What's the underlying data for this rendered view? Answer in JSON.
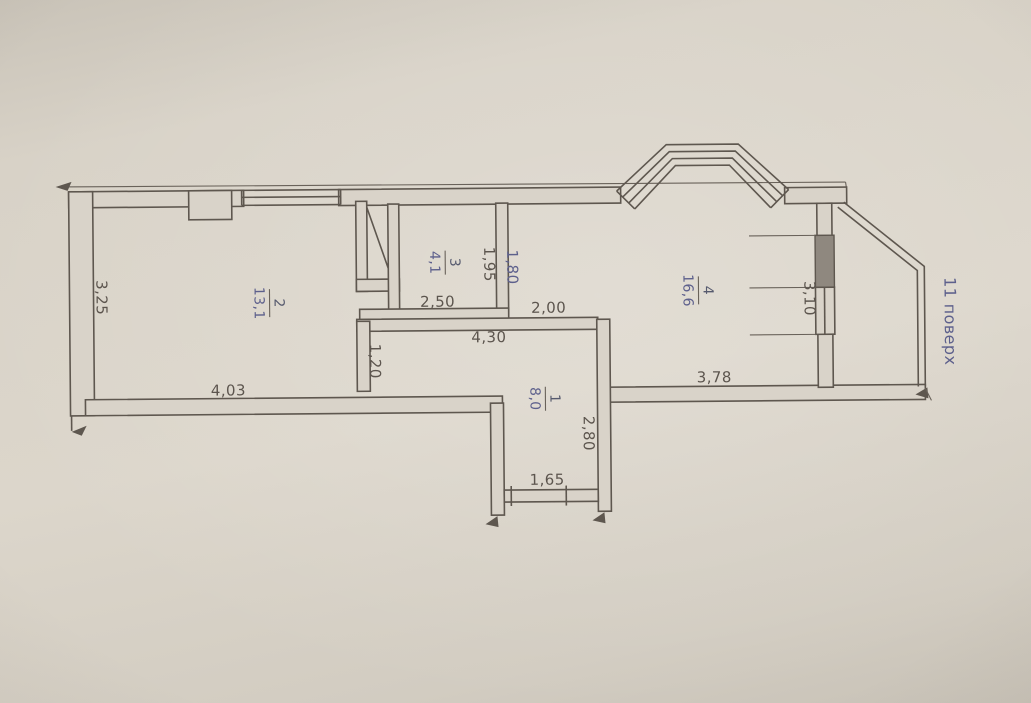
{
  "document": {
    "kind": "apartment floor plan photo",
    "floor_note": "11 поверх"
  },
  "rooms": {
    "r1": {
      "number": "1",
      "area": "8,0"
    },
    "r2": {
      "number": "2",
      "area": "13,1"
    },
    "r3": {
      "number": "3",
      "area": "4,1"
    },
    "r4": {
      "number": "4",
      "area": "16,6"
    }
  },
  "dimensions": {
    "left_wall_height": "3,25",
    "room2_width": "4,03",
    "room2_partition": "1,20",
    "room3_width": "2,50",
    "hall_total_width": "4,30",
    "room3_depth": "1,95",
    "room3_right_wall": "1,80",
    "room4_nook_width": "2,00",
    "room4_window_height": "3,10",
    "room4_width": "3,78",
    "hall_depth": "2,80",
    "entrance_width": "1,65"
  },
  "colors": {
    "paper": "#d8d2c7",
    "ink": "#5f574e",
    "blue_ink": "#5d6090"
  }
}
